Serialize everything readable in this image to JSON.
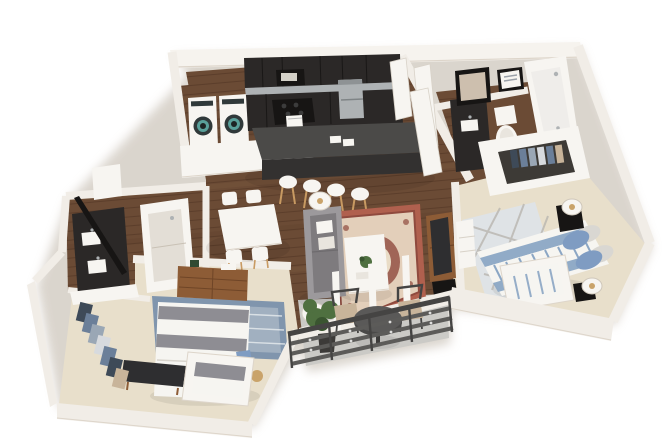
{
  "meta": {
    "type": "3d-floor-plan-rendering",
    "view": "isometric",
    "description": "3D rendered floor plan of an apartment with kitchen, dining area, living room, two bedrooms, two bathrooms, walk-in closets, laundry closet and a balcony",
    "background": "#ffffff"
  },
  "colors": {
    "background": "#ffffff",
    "wallFace": "#f1ede7",
    "wallTop": "#f6f3ee",
    "wallShadow": "#ddd5ca",
    "wallEdge": "#cfc7ba",
    "woodFloor": "#6b4b35",
    "plankLine": "#4e3323",
    "woodLight": "#8a6144",
    "carpet": "#e8dfcb",
    "carpetShadow": "#d9cfb8",
    "balconyFloor": "#cbcac6",
    "cabinetDark": "#2b2827",
    "cabinetBlack": "#171514",
    "steel": "#aeb2b4",
    "islandTop": "#4b4a48",
    "islandFace": "#333130",
    "white": "#f7f5f1",
    "offWhite": "#e9e5de",
    "sofaGray": "#9c999c",
    "sofaDark": "#7e7b7e",
    "rugRed": "#b0604e",
    "rugCream": "#e9dcc6",
    "rugRedDark": "#8f4a3e",
    "rugBlue": "#8095ad",
    "rugBlueLight": "#dfe3e6",
    "bedWhite": "#f6f5f1",
    "bedGray": "#8e8d93",
    "stripeBlue": "#8ba6c4",
    "pillowBlue": "#7f9cc2",
    "woodFurn": "#8d5c36",
    "woodFurnDark": "#6f4527",
    "tvDark": "#2e2e30",
    "railing": "#5c5b59",
    "railingDark": "#454443",
    "plantGreen": "#4f7040",
    "plantDark": "#3a5530",
    "plantPot": "#3c3a38",
    "brass": "#c9a36a",
    "washerDoor": "#30393a",
    "washerGlass": "#59a09a",
    "clothesNavy": "#3e4a58",
    "clothesBlue": "#6b7f99",
    "clothesGray": "#9aa7b5",
    "clothesLight": "#d7dade",
    "clothesTan": "#c8b49a",
    "tubInner": "#efedea",
    "mirrorGlass": "#cdbfae"
  },
  "rooms": [
    {
      "id": "laundry-closet",
      "furniture": [
        "washer",
        "dryer"
      ]
    },
    {
      "id": "kitchen",
      "furniture": [
        "upper-cabinets",
        "microwave",
        "range-with-towel",
        "refrigerator",
        "base-cabinets",
        "island-with-sink",
        "bar-stool-x4"
      ]
    },
    {
      "id": "entry",
      "furniture": [
        "open-door-x2"
      ]
    },
    {
      "id": "dining-area",
      "furniture": [
        "dining-table",
        "dining-chair-x4"
      ]
    },
    {
      "id": "living-room",
      "furniture": [
        "sofa",
        "floor-lamp-x2",
        "coffee-table",
        "oriental-area-rug",
        "tv-console",
        "tv"
      ]
    },
    {
      "id": "bathroom-top-right",
      "furniture": [
        "vanity",
        "sink",
        "mirror",
        "wall-art",
        "toilet",
        "bathtub",
        "open-door"
      ]
    },
    {
      "id": "walk-in-closet-right",
      "furniture": [
        "hanging-clothes"
      ]
    },
    {
      "id": "bedroom-right",
      "furniture": [
        "bed-with-striped-duvet",
        "pillows",
        "nightstand-x2",
        "table-lamp-x2",
        "window-seat",
        "geometric-rug",
        "white-dresser",
        "media-console"
      ]
    },
    {
      "id": "bathroom-left",
      "furniture": [
        "double-vanity",
        "sink-x2",
        "leaning-mirror",
        "linen-cabinet",
        "walk-in-shower"
      ]
    },
    {
      "id": "bedroom-left",
      "furniture": [
        "bed",
        "dresser",
        "patterned-area-rug",
        "media-bench-tv",
        "window-seat",
        "closet-hanging-clothes"
      ]
    },
    {
      "id": "balcony",
      "furniture": [
        "bistro-table",
        "patio-chair-x2",
        "potted-plant",
        "slat-railing"
      ]
    }
  ]
}
